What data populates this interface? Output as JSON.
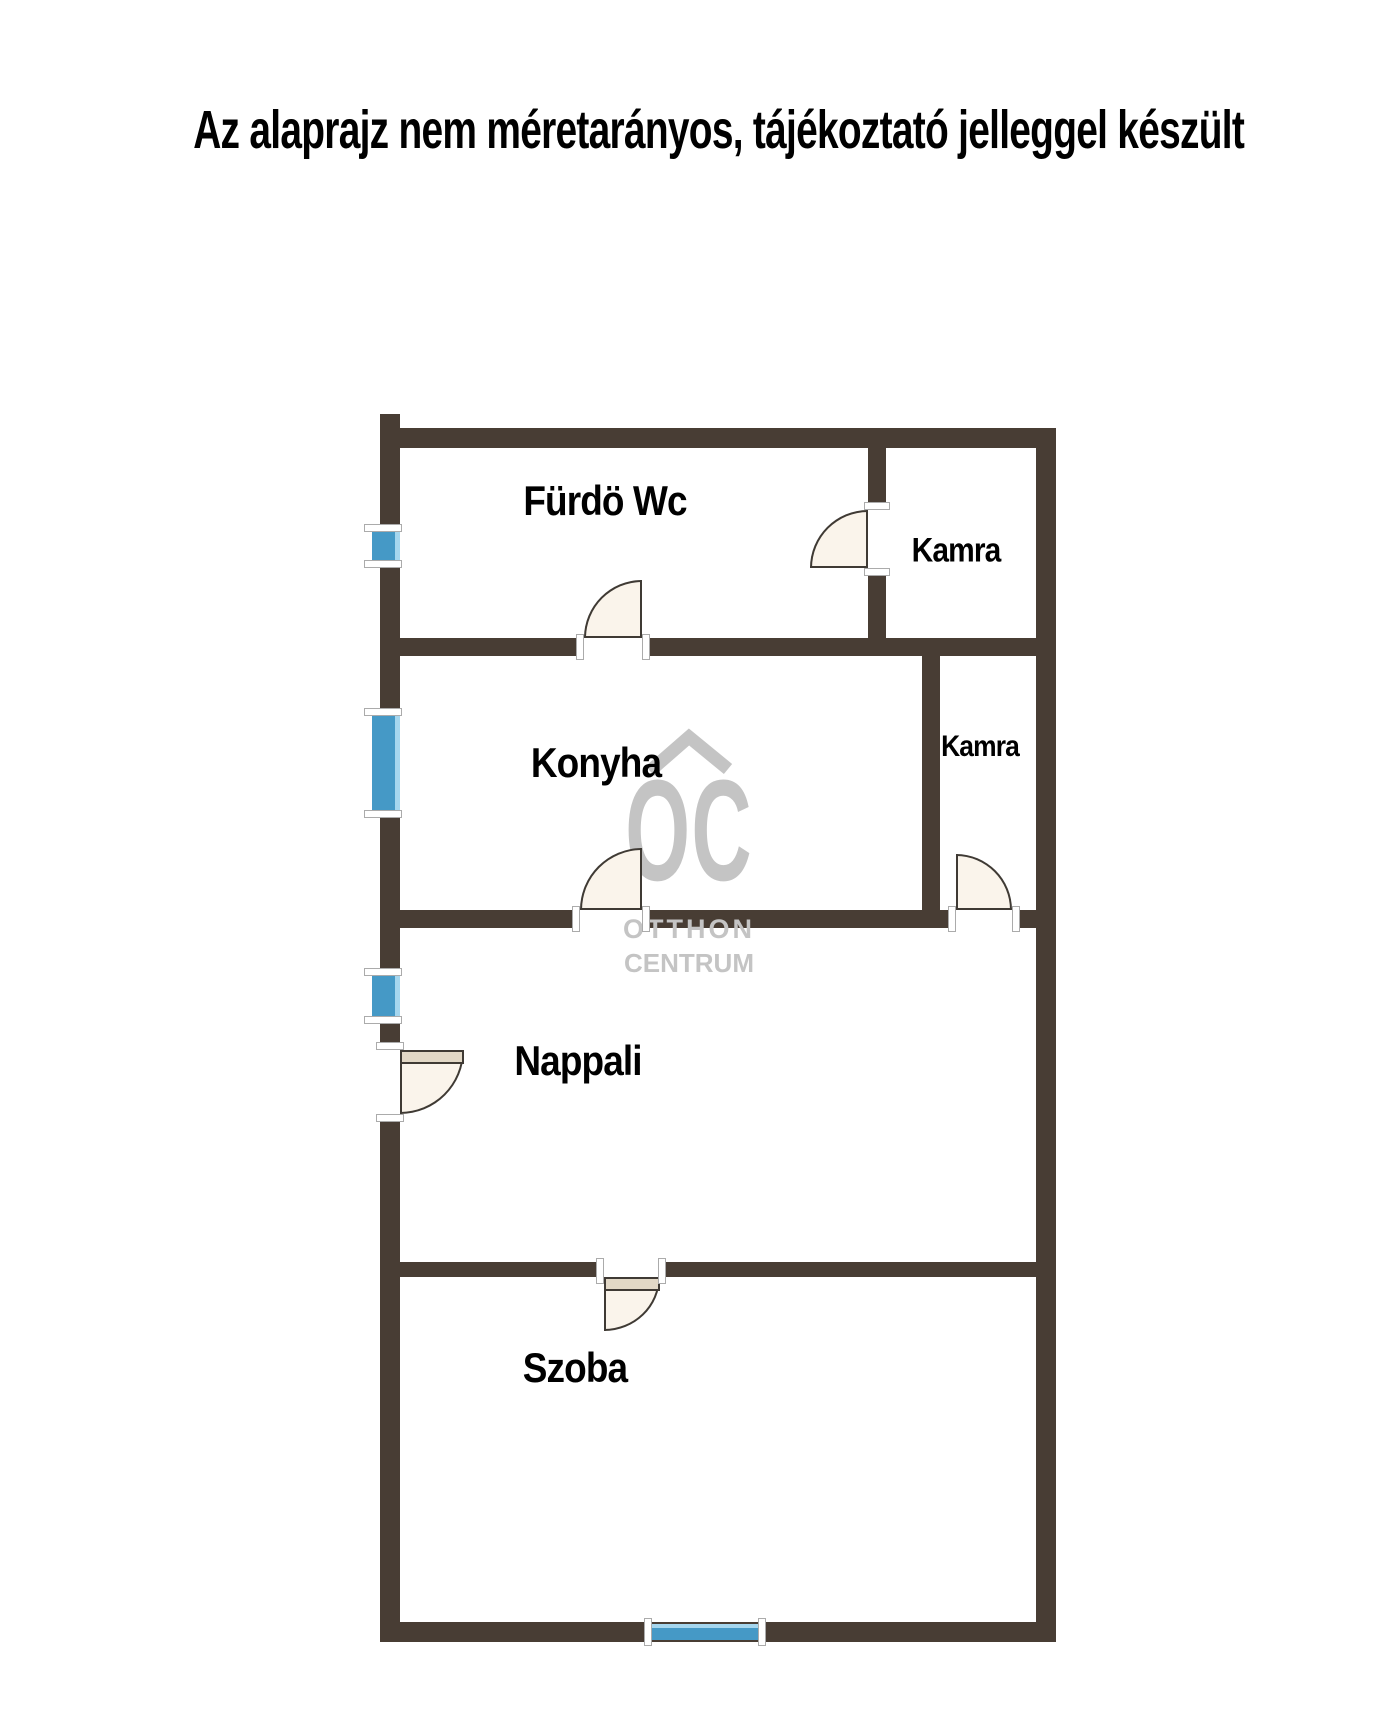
{
  "title": "Az alaprajz nem méretarányos, tájékoztató jelleggel készült",
  "watermark": {
    "logo": "OC",
    "line1": "OTTHON",
    "line2": "CENTRUM"
  },
  "rooms": {
    "furdo_wc": {
      "label": "Fürdö Wc"
    },
    "kamra_top": {
      "label": "Kamra"
    },
    "konyha": {
      "label": "Konyha"
    },
    "kamra_small": {
      "label": "Kamra"
    },
    "nappali": {
      "label": "Nappali"
    },
    "szoba": {
      "label": "Szoba"
    }
  },
  "colors": {
    "background": "#ffffff",
    "text": "#000000",
    "wall": "#483d34",
    "window": "#4599c6",
    "window_light": "#a5d6ee",
    "door_fill": "#faf4eb",
    "door_leaf": "#e2d8c6",
    "door_outline": "#3f3a34",
    "trim": "#ffffff",
    "trim_border": "#ababab",
    "watermark": "#c4c4c4"
  }
}
